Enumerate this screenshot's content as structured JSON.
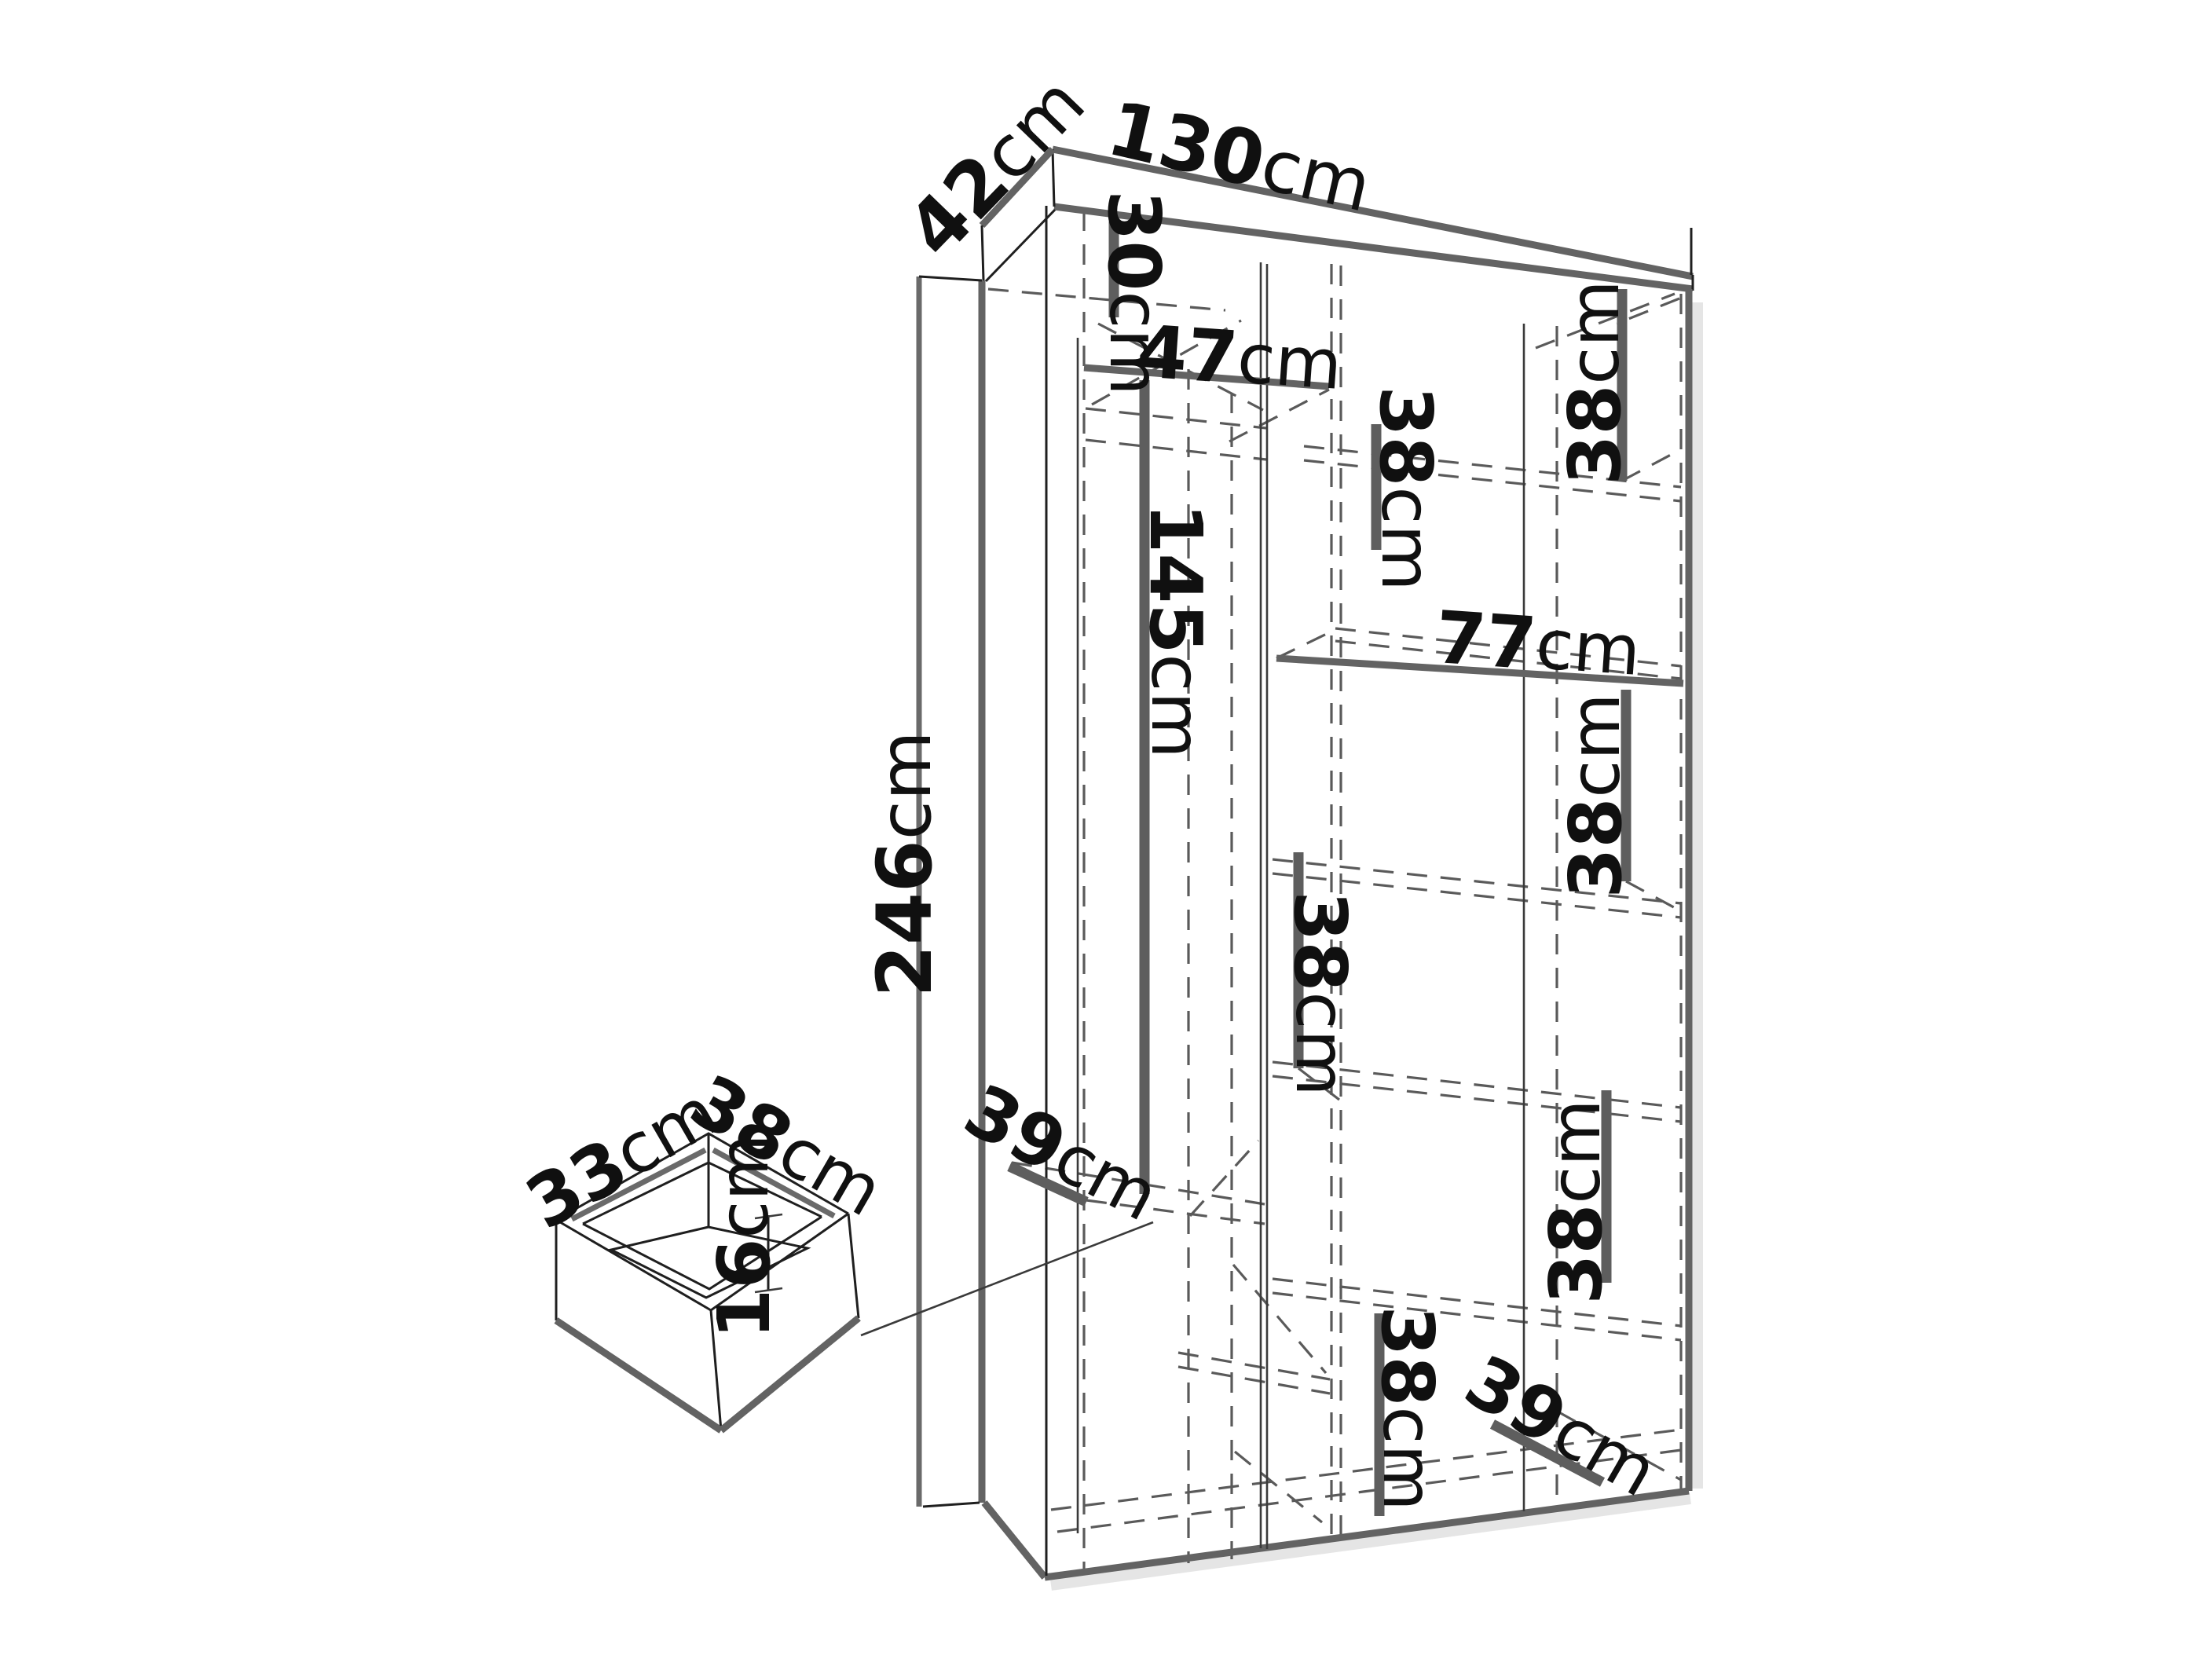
{
  "page": {
    "background": "#ffffff"
  },
  "diagram": {
    "type": "furniture-dimension-diagram",
    "colors": {
      "line_dark": "#1f1f1f",
      "line_gray": "#636363",
      "dash_gray": "#5a5a5a",
      "text": "#101010"
    },
    "wardrobe": {
      "overall": {
        "width": {
          "num": "130",
          "unit": "cm"
        },
        "depth": {
          "num": "42",
          "unit": "cm"
        },
        "height": {
          "num": "246",
          "unit": "cm"
        }
      },
      "sections": {
        "top_left_height": {
          "num": "30",
          "unit": "cm"
        },
        "left_shelf_width": {
          "num": "47",
          "unit": "cm"
        },
        "hanging_height": {
          "num": "145",
          "unit": "cm"
        },
        "right_col_width": {
          "num": "77",
          "unit": "cm"
        },
        "gap_a": {
          "num": "38",
          "unit": "cm"
        },
        "gap_b": {
          "num": "38",
          "unit": "cm"
        },
        "gap_c": {
          "num": "38",
          "unit": "cm"
        },
        "gap_d": {
          "num": "38",
          "unit": "cm"
        },
        "gap_e": {
          "num": "38",
          "unit": "cm"
        },
        "gap_f": {
          "num": "38",
          "unit": "cm"
        },
        "left_shelf_depth": {
          "num": "39",
          "unit": "cm"
        },
        "bottom_shelf_depth": {
          "num": "39",
          "unit": "cm"
        }
      }
    },
    "drawer": {
      "width": {
        "num": "33",
        "unit": "cm"
      },
      "depth": {
        "num": "38",
        "unit": "cm"
      },
      "height": {
        "num": "16",
        "unit": "cm"
      }
    }
  }
}
